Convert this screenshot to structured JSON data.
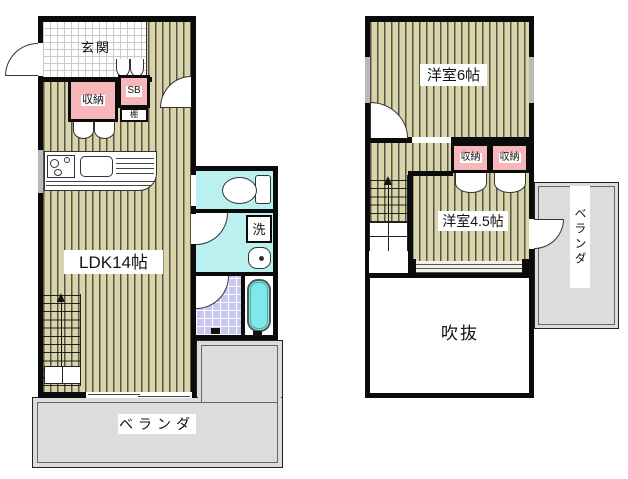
{
  "floor1": {
    "entrance": "玄関",
    "storage": "収納",
    "shoe_box": "SB",
    "shelf": "棚",
    "ldk": "LDK14帖",
    "wash": "洗",
    "veranda": "ベランダ"
  },
  "floor2": {
    "room6": "洋室6帖",
    "storage_left": "収納",
    "storage_right": "収納",
    "room45": "洋室4.5帖",
    "void": "吹抜",
    "veranda": "ベランダ"
  },
  "colors": {
    "wall": "#0b0b0b",
    "floor_stripe_base": "#d9d5a9",
    "floor_stripe_line": "#55534a",
    "closet_pink": "#f7b6ba",
    "water_cyan": "#baf0f0",
    "bath_tile_lavender": "#c9c6ef",
    "bathtub_cyan": "#7fe9e9",
    "veranda_gray": "#dcdcdc",
    "entrance_tile": "#ffffff"
  }
}
